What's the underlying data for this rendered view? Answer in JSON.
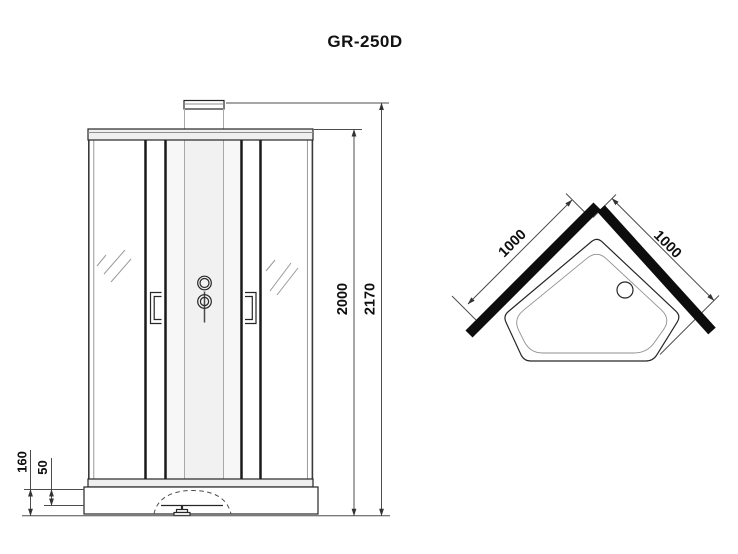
{
  "title": "GR-250D",
  "front_view": {
    "dim_total_height": "2170",
    "dim_cabin_height": "2000",
    "dim_tray_height": "160",
    "dim_tray_inner_depth": "50"
  },
  "top_view": {
    "dim_left_side": "1000",
    "dim_right_side": "1000"
  },
  "colors": {
    "line": "#262626",
    "dim_line": "#4d4d4d",
    "wall": "#0d0d0d",
    "rail_fill": "#efefef"
  }
}
